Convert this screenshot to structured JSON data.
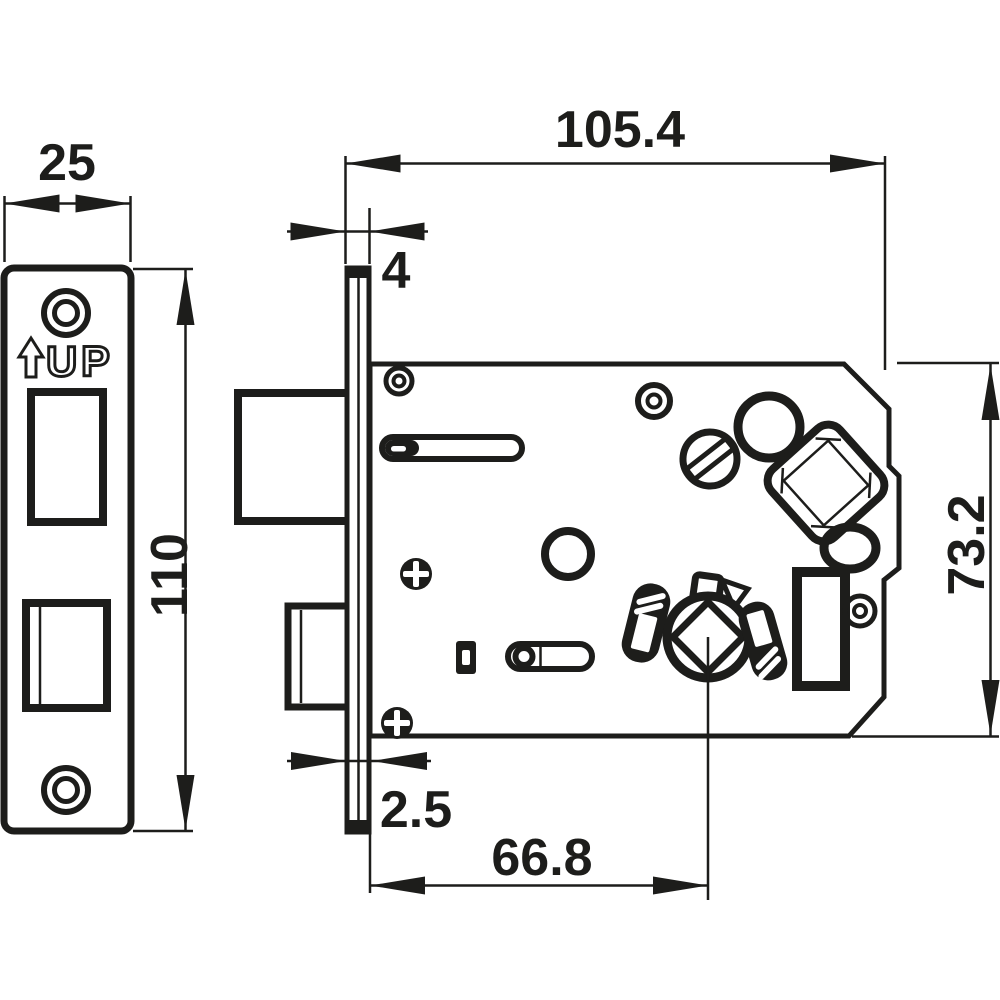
{
  "drawing": {
    "type": "mortise-lock-technical-drawing",
    "background_color": "#ffffff",
    "line_color": "#1d1d1b",
    "front_view": {
      "width_label": "25",
      "height_label": "110",
      "orientation_label": "UP"
    },
    "side_view": {
      "depth_label": "105.4",
      "faceplate_lip_label": "4",
      "body_height_label": "73.2",
      "faceplate_thickness_label": "2.5",
      "backset_label": "66.8"
    }
  }
}
